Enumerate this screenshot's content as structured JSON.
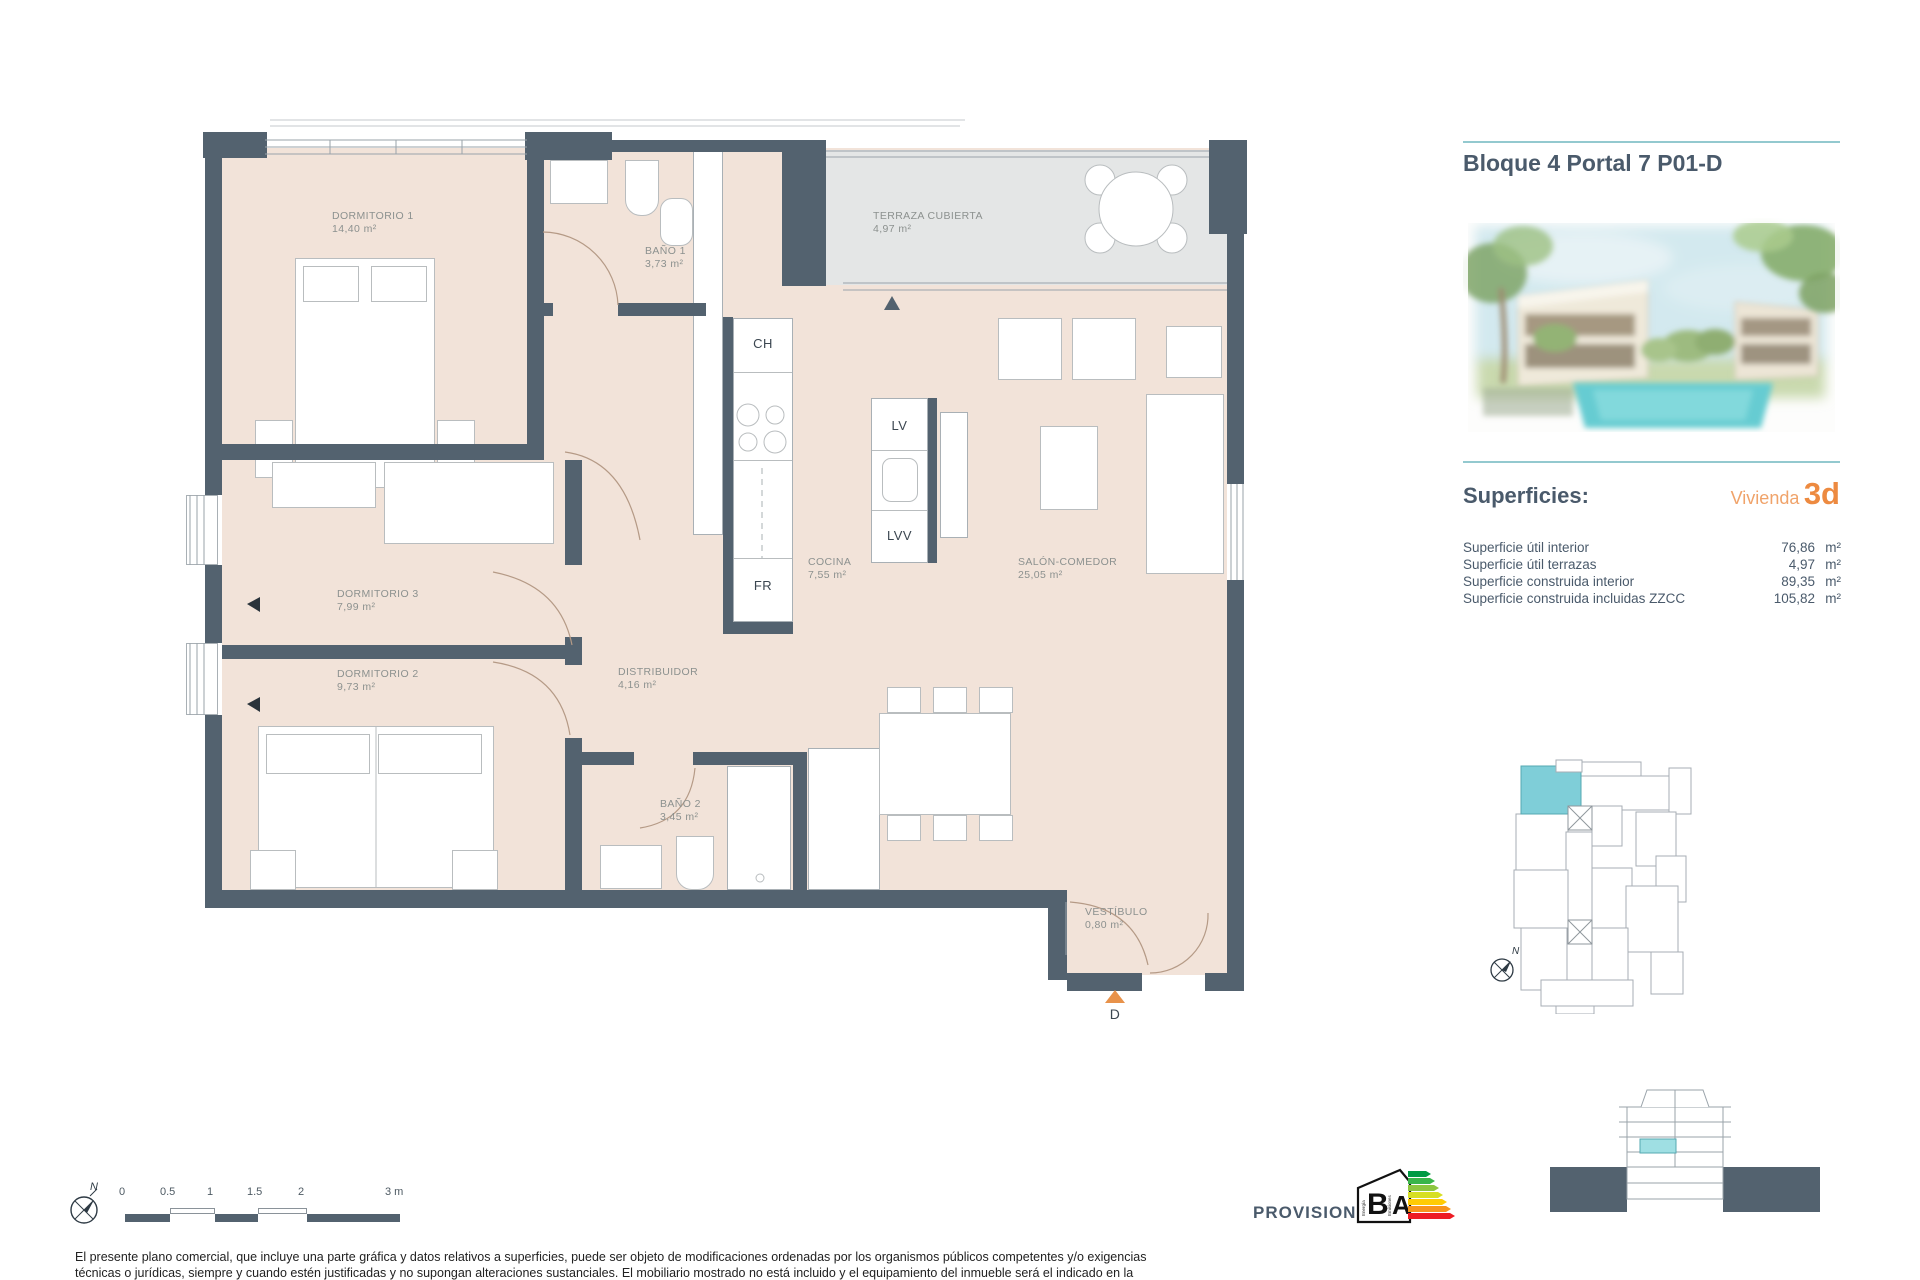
{
  "header": {
    "title": "Bloque 4 Portal 7 P01-D"
  },
  "superficies": {
    "heading": "Superficies:",
    "vivienda_label": "Vivienda",
    "vivienda_code": "3d",
    "rows": [
      {
        "label": "Superficie útil interior",
        "value": "76,86",
        "unit": "m²"
      },
      {
        "label": "Superficie útil terrazas",
        "value": "4,97",
        "unit": "m²"
      },
      {
        "label": "Superficie construida interior",
        "value": "89,35",
        "unit": "m²"
      },
      {
        "label": "Superficie construida incluidas ZZCC",
        "value": "105,82",
        "unit": "m²"
      }
    ]
  },
  "plan": {
    "rooms": [
      {
        "name": "DORMITORIO 1",
        "area": "14,40 m²"
      },
      {
        "name": "BAÑO 1",
        "area": "3,73 m²"
      },
      {
        "name": "TERRAZA CUBIERTA",
        "area": "4,97 m²"
      },
      {
        "name": "DORMITORIO 3",
        "area": "7,99 m²"
      },
      {
        "name": "DORMITORIO 2",
        "area": "9,73 m²"
      },
      {
        "name": "DISTRIBUIDOR",
        "area": "4,16 m²"
      },
      {
        "name": "COCINA",
        "area": "7,55 m²"
      },
      {
        "name": "SALÓN-COMEDOR",
        "area": "25,05 m²"
      },
      {
        "name": "BAÑO 2",
        "area": "3,45 m²"
      },
      {
        "name": "VESTÍBULO",
        "area": "0,80 m²"
      }
    ],
    "appliances": {
      "ch": "CH",
      "lv": "LV",
      "lvv": "LVV",
      "fr": "FR"
    },
    "entry_label": "D"
  },
  "scale_bar": {
    "ticks": [
      "0",
      "0.5",
      "1",
      "1.5",
      "2",
      "3 m"
    ]
  },
  "compass": {
    "north": "N"
  },
  "key_plan": {
    "north": "N"
  },
  "footer": {
    "provisional": "PROVISIONAL",
    "energy_label": {
      "letter_b": "B",
      "letter_a": "A",
      "energia": "Energía",
      "emisiones": "Emisiones"
    },
    "disclaimer_line1": "El presente plano comercial, que incluye una parte gráfica y datos relativos a superficies, puede ser objeto de modificaciones ordenadas por los organismos públicos competentes y/o exigencias",
    "disclaimer_line2": "técnicas o jurídicas, siempre y cuando estén justificadas y no supongan alteraciones sustanciales. El mobiliario mostrado no está incluido y el equipamiento del inmueble será el indicado en la"
  },
  "colors": {
    "wall": "#53626f",
    "floor": "#f2e3d9",
    "terrace": "#e4e6e6",
    "teal_line": "#93c9cf",
    "accent_orange": "#ed8a40",
    "unit_highlight": "#7fced8"
  }
}
